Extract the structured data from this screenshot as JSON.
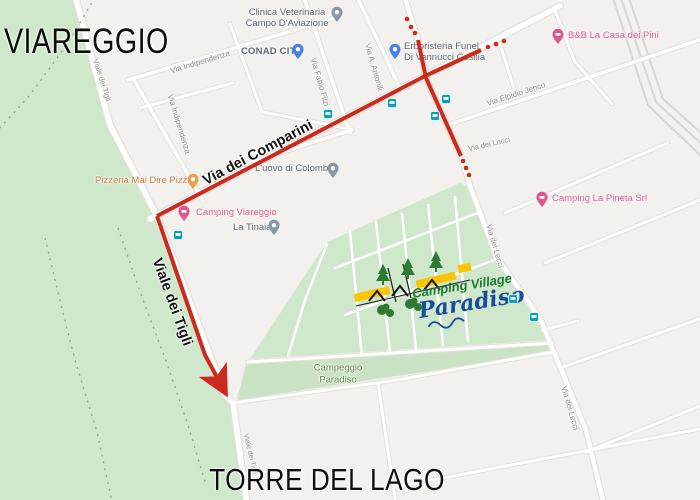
{
  "city_labels": {
    "top": "VIAREGGIO",
    "bottom": "TORRE DEL LAGO"
  },
  "pois": [
    {
      "id": "clinica-veterinaria",
      "line1": "Clinica Veterinaria",
      "line2": "Campo D'Aviazione",
      "pin": "grey"
    },
    {
      "id": "conad-city",
      "label": "CONAD CITY",
      "pin": "blue"
    },
    {
      "id": "erboristeria",
      "line1": "Erboristeria Funel",
      "line2": "Di Vannucci Cesilia",
      "pin": "blue"
    },
    {
      "id": "bnb-casa-dei-pini",
      "label": "B&B La Casa dei Pini",
      "pin": "pink"
    },
    {
      "id": "pizzeria-mai-dire-pizza",
      "label": "Pizzeria Mai Dire Pizza",
      "pin": "orange"
    },
    {
      "id": "camping-viareggio",
      "label": "Camping Viareggio",
      "pin": "pink"
    },
    {
      "id": "la-tinaia",
      "label": "La Tinaia",
      "pin": "grey"
    },
    {
      "id": "uovo-di-colombo",
      "label": "L'uovo di Colombo",
      "pin": "grey"
    },
    {
      "id": "camping-la-pineta",
      "label": "Camping La Pineta Srl",
      "pin": "pink"
    }
  ],
  "road_labels": [
    {
      "text": "Via Indipendenza"
    },
    {
      "text": "Via Indipendenza"
    },
    {
      "text": "Via Fabio Filzi"
    },
    {
      "text": "Via A. Antonili"
    },
    {
      "text": "Via Elpidio Jenco"
    },
    {
      "text": "Via dei Comparini",
      "big": true
    },
    {
      "text": "Via dei Comparini"
    },
    {
      "text": "Via dei Lecci"
    },
    {
      "text": "Via dei Lecci"
    },
    {
      "text": "Via dei Lecci"
    },
    {
      "text": "Viale dei Tigli",
      "big": true
    },
    {
      "text": "Viale dei Tigli"
    },
    {
      "text": "Viale dei Tigli"
    }
  ],
  "camp_area_label": {
    "line1": "Campeggio",
    "line2": "Paradiso"
  },
  "logo": {
    "line1": "Camping Village",
    "line2": "Paradiso"
  },
  "icons": {
    "transit_stop": "teal-square-transit-badge",
    "poi_pin": "teardrop-map-pin",
    "route_arrow": "red-arrowhead"
  },
  "colors": {
    "route": "#cc2a1c",
    "forest_green": "#cfe7ca",
    "camp_green": "#cfe7ca",
    "land": "#f2f1ee",
    "road": "#ffffff",
    "transit_icon": "#00a3c4",
    "pin_pink": "#e0578f",
    "pin_blue": "#4d7fe3",
    "pin_orange": "#ef9c49",
    "pin_grey": "#8a97a5",
    "logo_green": "#1e7a34",
    "logo_blue": "#1b4c9c",
    "logo_yellow": "#fcc500"
  }
}
